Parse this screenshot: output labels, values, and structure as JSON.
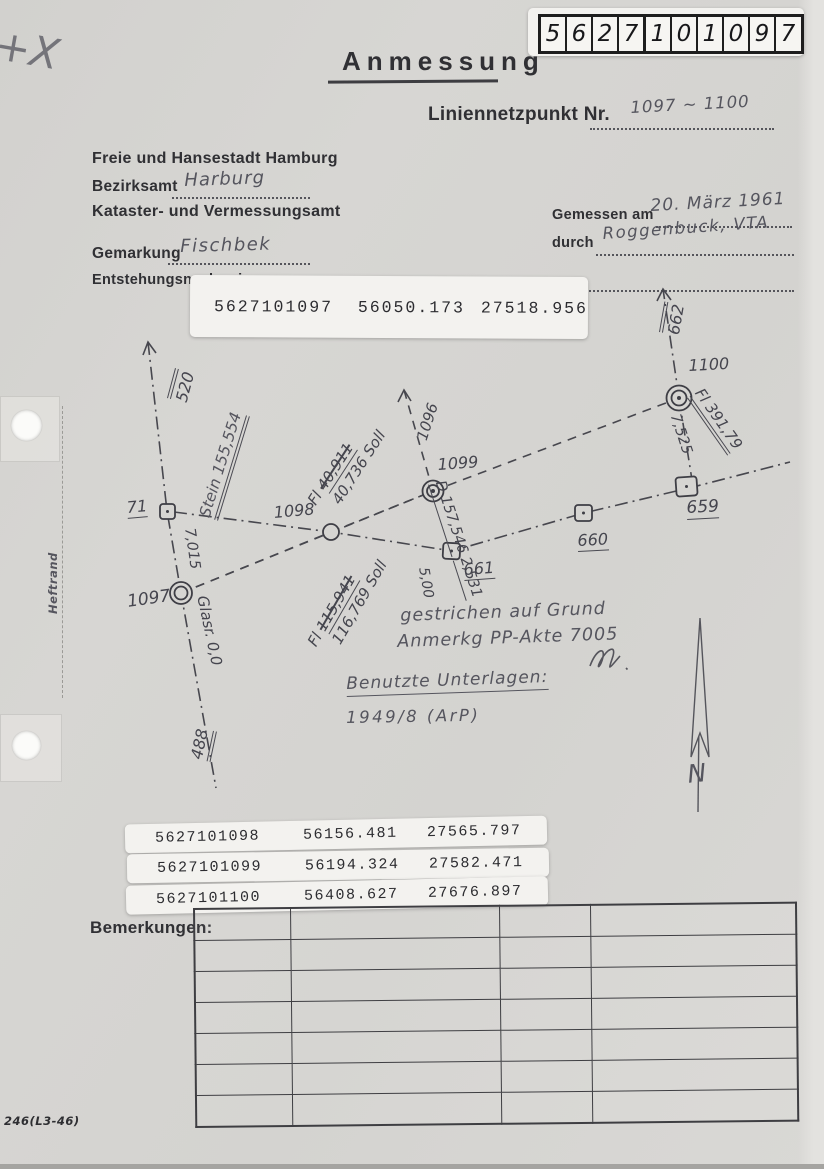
{
  "scan": {
    "pencil_mark": "+X",
    "margin_label": "Heftrand",
    "form_number": "246(L3-46)"
  },
  "id_box": {
    "digits": [
      "5",
      "6",
      "2",
      "7",
      "1",
      "0",
      "1",
      "0",
      "9",
      "7"
    ]
  },
  "header": {
    "title": "Anmessung",
    "point_label": "Liniennetzpunkt Nr.",
    "point_value": "1097 ~ 1100",
    "authority": "Freie und Hansestadt Hamburg",
    "district_label": "Bezirksamt",
    "district_value": "Harburg",
    "office": "Kataster- und Vermessungsamt",
    "gemarkung_label": "Gemarkung",
    "gemarkung_value": "Fischbek",
    "provenance_label": "Entstehungsnachweis",
    "measured_label": "Gemessen am",
    "measured_value": "20. März 1961",
    "by_label": "durch",
    "by_value": "Roggenbuck, VTA"
  },
  "coordinates": {
    "main": {
      "point": "5627101097",
      "easting": "56050.173",
      "northing": "27518.956"
    },
    "strips": [
      {
        "point": "5627101098",
        "easting": "56156.481",
        "northing": "27565.797"
      },
      {
        "point": "5627101099",
        "easting": "56194.324",
        "northing": "27582.471"
      },
      {
        "point": "5627101100",
        "easting": "56408.627",
        "northing": "27676.897"
      }
    ]
  },
  "sketch": {
    "labels": {
      "line_520": "520",
      "point_71": "71",
      "stein": "Stein 155,554",
      "dist_7015": "7,015",
      "point_1097": "1097",
      "glasr": "Glasr. 0,0",
      "line_488": "488",
      "point_1098": "1098",
      "fl_1098_prefix": "Fl",
      "fl_1098_old": "40,911",
      "fl_1098_new": "40,736 Soll",
      "line_1096": "1096",
      "point_1099": "1099",
      "d_value": "D 157,546",
      "d_offset": "2,531",
      "point_661": "661",
      "dist_500": "5,00",
      "point_660": "660",
      "point_659": "659",
      "point_1100": "1100",
      "line_662": "662",
      "fl_1100": "Fl 391,79",
      "dist_7525": "7,525",
      "fl_1097_prefix": "Fl",
      "fl_1097_old": "115,941",
      "fl_1097_new": "116,769 Soll",
      "north": "N"
    }
  },
  "notes": {
    "strike_line1": "gestrichen auf Grund",
    "strike_line2": "Anmerkg PP-Akte 7005",
    "sources_label": "Benutzte Unterlagen:",
    "sources_value": "1949/8  (ArP)"
  },
  "remarks": {
    "label": "Bemerkungen:"
  }
}
